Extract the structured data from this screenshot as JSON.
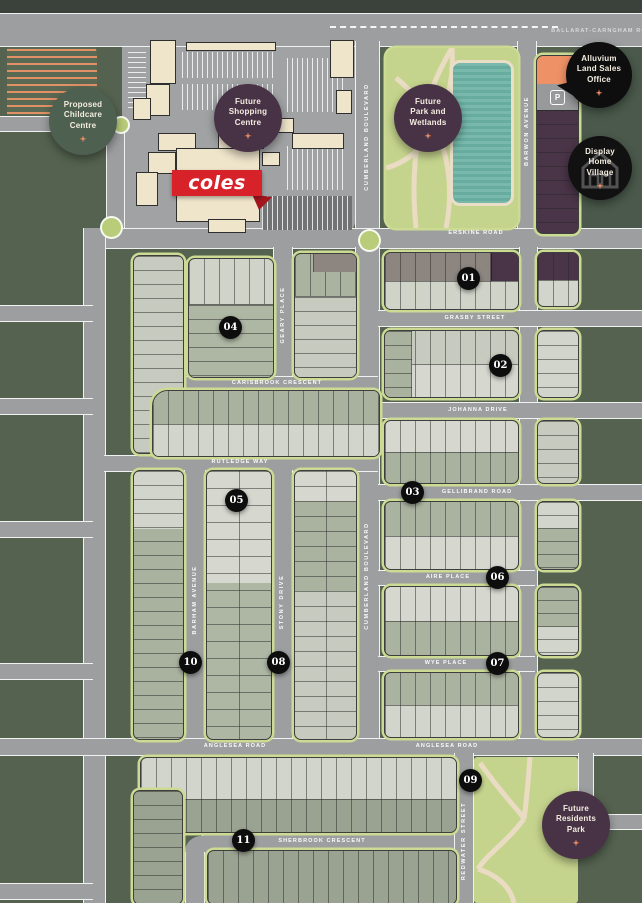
{
  "streets": [
    {
      "text": "BALLARAT-CARNGHAM ROAD"
    },
    {
      "text": "ERSKINE ROAD"
    },
    {
      "text": "GRASBY STREET"
    },
    {
      "text": "JOHANNA DRIVE"
    },
    {
      "text": "CARISBROOK CRESCENT"
    },
    {
      "text": "RUTLEDGE WAY"
    },
    {
      "text": "GELLIBRAND ROAD"
    },
    {
      "text": "AIRE PLACE"
    },
    {
      "text": "WYE PLACE"
    },
    {
      "text": "ANGLESEA ROAD"
    },
    {
      "text": "ANGLESEA ROAD"
    },
    {
      "text": "SHERBROOK CRESCENT"
    },
    {
      "text": "CUMBERLAND BOULEVARD"
    },
    {
      "text": "CUMBERLAND BOULEVARD"
    },
    {
      "text": "BARWON AVENUE"
    },
    {
      "text": "GEARY PLACE"
    },
    {
      "text": "BARHAM AVENUE"
    },
    {
      "text": "STONY DRIVE"
    },
    {
      "text": "REDWATER STREET"
    }
  ],
  "pois": [
    {
      "id": "proposed-childcare-centre",
      "text": "Proposed\nChildcare\nCentre"
    },
    {
      "id": "future-shopping-centre",
      "text": "Future\nShopping\nCentre"
    },
    {
      "id": "future-park-and-wetlands",
      "text": "Future\nPark and\nWetlands"
    },
    {
      "id": "alluvium-land-sales-office",
      "text": "Alluvium\nLand Sales\nOffice"
    },
    {
      "id": "display-home-village",
      "text": "Display\nHome\nVillage"
    },
    {
      "id": "future-residents-park",
      "text": "Future\nResidents\nPark"
    }
  ],
  "stage_numbers": [
    "01",
    "02",
    "03",
    "04",
    "05",
    "06",
    "07",
    "08",
    "09",
    "10",
    "11"
  ],
  "coles": {
    "label": "coles"
  },
  "parking": {
    "label": "P"
  },
  "colors": {
    "estate_green": "#54624f",
    "outer_dark": "#3b423b",
    "road_gray": "#9c9ea0",
    "park_green": "#c5d48d",
    "wetland_teal": "#6fb2a5",
    "badge_purple": "#483346",
    "badge_green": "#4e604f",
    "badge_black": "#0e0e0e",
    "lot_light": "#d2d5cb",
    "lot_sage": "#a9b29f",
    "lot_taupe": "#8c8580",
    "lot_purple": "#4a3447",
    "accent_orange": "#ec8d63",
    "coles_red": "#d8222a"
  }
}
